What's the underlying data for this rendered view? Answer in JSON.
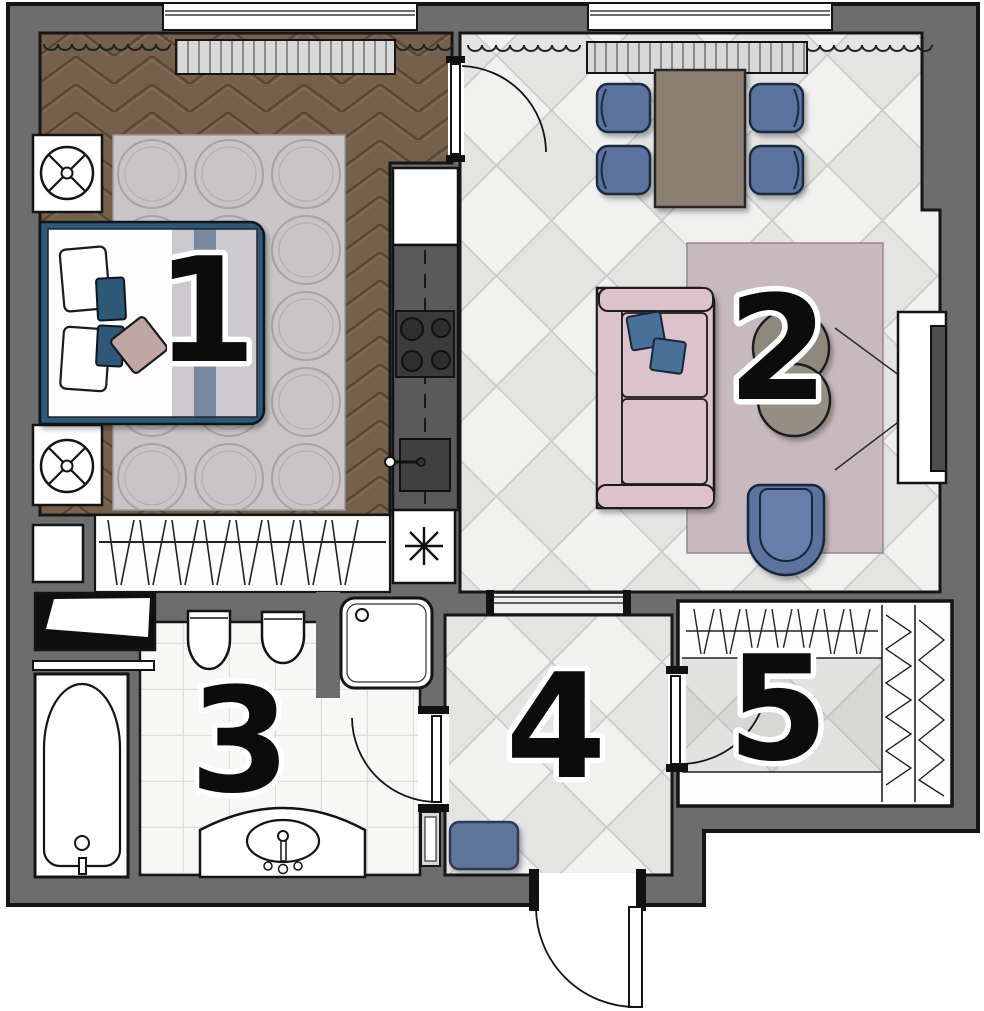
{
  "plan": {
    "rooms": [
      {
        "number": "1"
      },
      {
        "number": "2"
      },
      {
        "number": "3"
      },
      {
        "number": "4"
      },
      {
        "number": "5"
      }
    ]
  },
  "colors": {
    "wall": "#6d6d6d",
    "outline": "#141414",
    "bedroom_floor": "#75604b",
    "bedroom_floor_line": "#57452f",
    "tile_light": "#f1f1f0",
    "tile_alt": "#e4e4e3",
    "tile_line": "#c7c7c6",
    "bath_tile": "#f7f7f6",
    "bath_tile_line": "#dddddc",
    "accent_blue": "#5b73a0",
    "dark_blue": "#2f5878",
    "sofa_pink": "#dcc3cb",
    "rug_pink": "#c8b9be",
    "rug_gray": "#c9c4c6",
    "table_brown": "#8b7f73",
    "coffee_gray": "#8d8a7d",
    "duvet_gray": "#cbc9ce",
    "duvet_stripe": "#78889f",
    "pillow_rose": "#bfa8a3",
    "counter_dark": "#5a5a5a",
    "appliance_dark": "#3b3b3b",
    "doormat_blue": "#5f7499",
    "radiator_fill": "#d8d8d8",
    "label_color": "#0c0c0c",
    "label_halo": "#ffffff"
  }
}
